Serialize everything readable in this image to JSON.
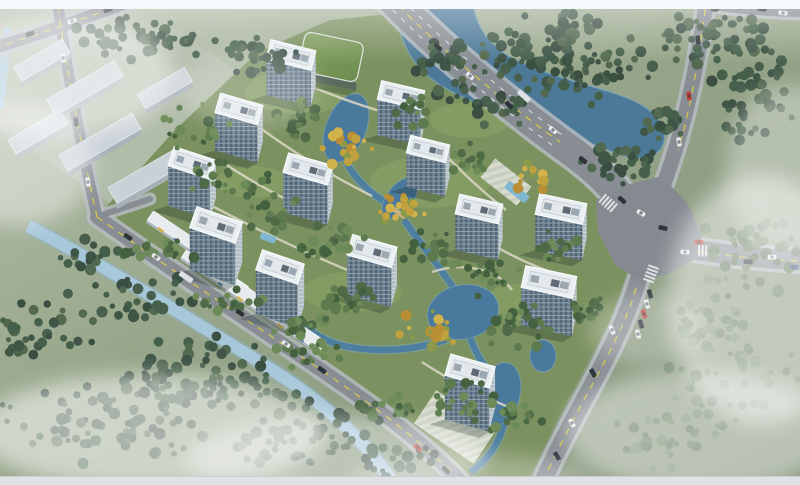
{
  "scene": {
    "type": "architectural-aerial-rendering",
    "title": "Residential community aerial rendering",
    "description": "Bird's-eye architectural rendering of a high-rise residential community: 13 white towers with blue-grey glazed facades, a green-roof clubhouse, landscaped gardens with ponds and autumn trees, a winding river, boundary roads with traffic and a large intersection, grey warehouses to the northwest and misty forest belts around the site.",
    "tower_count": 13,
    "view": "oblique aerial perspective"
  },
  "canvas": {
    "width": 800,
    "height": 485
  },
  "frame": {
    "top_band_h": 9,
    "bottom_band_h": 8,
    "top_band_color": "#f5f9fb",
    "bottom_band_color": "#dfe3e5"
  },
  "palette": {
    "ground_light": "#b7c1ae",
    "ground_mid": "#97a68a",
    "ground_dark": "#7e8f74",
    "site_green": "#7b9160",
    "lawn": "#8aa468",
    "field": "#b3bdab",
    "river": "#4d7998",
    "river_edge": "#7fa9c2",
    "canal": "#a7c7da",
    "canal_edge": "#8fb3c6",
    "lagoon": "#49799c",
    "stream": "#4f7fa0",
    "pool": "#7fb6d0",
    "asphalt": "#878d93",
    "asphalt_x": "#848a90",
    "sidewalk": "#b5bbc1",
    "line_yellow": "#d4c54b",
    "line_white": "#e8ebee",
    "roof": "#eaeff2",
    "roof_edge": "#f7fafb",
    "parapet": "#c3ccd2",
    "roof_inner": "#e2e8eb",
    "facade_end": "#b7c1c9",
    "unit_grey": "#9aa7b0",
    "unit_dark": "#5f6c77",
    "warehouse_roof": "#c9d1d7",
    "warehouse_side": "#a7b1b8",
    "warehouse_ridge": "#dde3e7",
    "green_roof_a": "#6f8c51",
    "green_roof_b": "#82a05f",
    "green_roof_side": "#5a6a5e",
    "strip_roof": "#e7ebee",
    "strip_side": "#aeb6bd",
    "strip_yellow": "#d9b34a",
    "strip_blue": "#5b84a8",
    "walkway": "#dcd7c4",
    "plaza_a": "#ccd1c4",
    "plaza_b": "#dde0d5",
    "bridge": "#c8b083",
    "shadow": "rgba(30,45,40,0.30)",
    "cars": {
      "d": "#2d3339",
      "w": "#e9ebed",
      "r": "#c2403a",
      "n": "#3c5a86",
      "t": "#dde1e4"
    },
    "trees": {
      "f": [
        "#3f5647",
        "#475f4c",
        "#52694f",
        "#3a4f42",
        "#44604a"
      ],
      "s": [
        "#4e6a46",
        "#5d7b4f",
        "#6d8b58",
        "#43603f"
      ],
      "a": [
        "#c2a23f",
        "#d1b24b",
        "#b98f35",
        "#8a9a4a"
      ],
      "l": [
        "#5c7258",
        "#67805f",
        "#72896a",
        "#617a5c"
      ]
    }
  },
  "ground": {
    "site_polygon": "96,218 175,130 258,52 330,20 390,14 445,55 520,115 575,158 618,205 636,248 610,320 565,405 528,480 470,482 420,430 340,382 250,318 160,262",
    "field_polygon": "0,38 140,4 250,80 210,150 120,210 0,130",
    "lawns": [
      [
        300,
        92,
        55,
        22
      ],
      [
        430,
        182,
        60,
        26
      ],
      [
        352,
        292,
        50,
        20
      ],
      [
        520,
        302,
        40,
        18
      ],
      [
        252,
        182,
        36,
        16
      ],
      [
        470,
        120,
        40,
        18
      ]
    ]
  },
  "water": {
    "river_path": "M394,8 L474,8 C478,30 492,48 516,60 C548,76 588,84 622,96 C650,106 668,122 664,142 C660,158 640,162 618,154 C586,142 552,128 516,116 C478,104 440,92 418,66 C404,50 398,28 394,8 Z",
    "canal_path": "M28,226 C105,266 188,318 266,366 C322,400 368,442 396,488",
    "creek_path": "M8,28 C5,55 3,80 0,108",
    "lagoon_blobs": [
      [
        346,
        128,
        20,
        36,
        22
      ],
      [
        400,
        198,
        13,
        24,
        38
      ],
      [
        463,
        312,
        36,
        27,
        -12
      ],
      [
        500,
        394,
        20,
        32,
        14
      ],
      [
        543,
        356,
        13,
        16,
        0
      ]
    ],
    "streams": [
      "M346,162 C358,184 376,198 396,208",
      "M404,220 C422,246 444,272 456,292",
      "M470,338 C478,358 488,372 496,380",
      "M504,424 C498,446 486,462 470,472",
      "M460,334 C424,350 382,354 344,346 C328,342 316,336 306,326"
    ],
    "bridge": [
      399,
      213,
      15,
      5,
      35
    ]
  },
  "roads": [
    {
      "name": "top-left-road",
      "d": "M-6,48 C40,34 92,16 150,-6",
      "w": 12,
      "mark": "M-6,48 C40,34 92,16 150,-6"
    },
    {
      "name": "west-road",
      "d": "M58,6 C68,78 82,150 97,217",
      "w": 11,
      "mark": "M58,6 C68,78 82,150 97,217"
    },
    {
      "name": "sw-boundary-road",
      "d": "M97,217 C160,262 235,312 302,357 C355,393 420,437 465,486",
      "w": 14,
      "mark": "M97,217 C160,262 235,312 302,357 C355,393 420,437 465,486"
    },
    {
      "name": "west-gate-spur",
      "d": "M99,216 L150,199",
      "w": 6
    },
    {
      "name": "top-arterial",
      "d": "M389,-4 C437,46 505,103 567,148 C595,168 614,186 628,208",
      "w": 30,
      "mark": "M389,-4 C437,46 505,103 560,142",
      "lane_offset": [
        4.6,
        -5.3
      ]
    },
    {
      "name": "northeast-road",
      "d": "M707,-4 C699,55 688,115 668,172 C664,184 660,196 657,206",
      "w": 15,
      "mark": "M707,-4 C700,50 692,105 678,150"
    },
    {
      "name": "east-road",
      "d": "M652,242 C700,252 750,258 806,261",
      "w": 20,
      "mark": "M700,252 C735,257 770,260 806,261"
    },
    {
      "name": "south-road",
      "d": "M642,266 C632,308 610,352 585,398 C568,430 552,460 540,488",
      "w": 17,
      "mark": "M636,288 C628,318 608,356 585,398 C568,430 552,460 540,488"
    },
    {
      "name": "top-right-frontage",
      "d": "M720,6 C750,10 780,12 806,12",
      "w": 10
    }
  ],
  "intersection_polygon": "596,200 630,184 662,176 688,204 702,236 694,260 668,274 642,282 616,266 598,232",
  "crosswalks": [
    [
      608,
      203,
      41
    ],
    [
      651,
      274,
      -70
    ],
    [
      706,
      251,
      2
    ]
  ],
  "warehouses": [
    [
      42,
      60,
      56,
      16
    ],
    [
      85,
      88,
      78,
      18
    ],
    [
      165,
      88,
      54,
      16
    ],
    [
      38,
      132,
      60,
      16
    ],
    [
      100,
      142,
      84,
      18
    ],
    [
      148,
      175,
      82,
      18
    ]
  ],
  "green_roof_building": {
    "x": 331,
    "y": 57,
    "w": 60,
    "d": 40,
    "rot": 12
  },
  "towers": [
    [
      291,
      55,
      46,
      20,
      36,
      14
    ],
    [
      401,
      95,
      44,
      19,
      36,
      13
    ],
    [
      239,
      109,
      44,
      20,
      38,
      16
    ],
    [
      428,
      149,
      40,
      18,
      34,
      14
    ],
    [
      192,
      163,
      44,
      20,
      40,
      18
    ],
    [
      308,
      169,
      46,
      20,
      40,
      16
    ],
    [
      479,
      209,
      44,
      20,
      36,
      13
    ],
    [
      561,
      209,
      48,
      21,
      36,
      12
    ],
    [
      216,
      225,
      48,
      22,
      42,
      19
    ],
    [
      372,
      251,
      46,
      21,
      40,
      16
    ],
    [
      280,
      267,
      44,
      21,
      44,
      19
    ],
    [
      549,
      282,
      52,
      22,
      38,
      12
    ],
    [
      470,
      371,
      46,
      22,
      44,
      16
    ]
  ],
  "commercial_strips": [
    [
      215,
      272,
      72,
      13,
      34
    ],
    [
      256,
      301,
      72,
      13,
      34
    ],
    [
      295,
      328,
      66,
      12,
      34
    ],
    [
      172,
      230,
      52,
      11,
      34
    ]
  ],
  "plazas": [
    [
      455,
      427,
      72,
      40,
      34
    ],
    [
      506,
      182,
      46,
      24,
      38
    ]
  ],
  "pools": [
    [
      517,
      192,
      26,
      9,
      38
    ],
    [
      268,
      238,
      16,
      7,
      20
    ]
  ],
  "walkways": [
    "M212,206 C262,232 312,256 362,276",
    "M252,122 C292,152 332,176 372,196",
    "M302,82 C332,96 362,106 396,116",
    "M432,142 C456,166 480,190 506,210",
    "M472,232 C502,252 532,266 562,276",
    "M422,362 C452,382 482,396 506,406",
    "M432,272 C462,262 496,268 512,290",
    "M222,162 C252,182 282,198 312,212"
  ],
  "tree_clusters": [
    [
      150,
      38,
      95,
      26,
      45,
      "f"
    ],
    [
      262,
      58,
      50,
      24,
      26,
      "f"
    ],
    [
      430,
      58,
      40,
      22,
      18,
      "f"
    ],
    [
      500,
      108,
      40,
      20,
      16,
      "f"
    ],
    [
      558,
      58,
      115,
      52,
      120,
      "f"
    ],
    [
      712,
      38,
      75,
      38,
      55,
      "f"
    ],
    [
      755,
      95,
      55,
      60,
      48,
      "f"
    ],
    [
      620,
      162,
      52,
      28,
      38,
      "f"
    ],
    [
      662,
      122,
      30,
      24,
      20,
      "f"
    ],
    [
      748,
      258,
      68,
      48,
      42,
      "l"
    ],
    [
      728,
      378,
      78,
      66,
      52,
      "l"
    ],
    [
      662,
      438,
      58,
      38,
      30,
      "l"
    ],
    [
      710,
      318,
      48,
      38,
      26,
      "l"
    ],
    [
      118,
      418,
      128,
      58,
      85,
      "f"
    ],
    [
      298,
      432,
      88,
      48,
      52,
      "f"
    ],
    [
      40,
      328,
      58,
      48,
      34,
      "f"
    ],
    [
      198,
      368,
      78,
      38,
      42,
      "f"
    ],
    [
      388,
      458,
      58,
      26,
      22,
      "f"
    ],
    [
      138,
      298,
      65,
      28,
      28,
      "f"
    ],
    [
      88,
      258,
      48,
      20,
      20,
      "f"
    ],
    [
      252,
      390,
      70,
      20,
      24,
      "f"
    ],
    [
      198,
      128,
      38,
      28,
      18,
      "s"
    ],
    [
      228,
      178,
      55,
      22,
      22,
      "s"
    ],
    [
      298,
      118,
      38,
      26,
      24,
      "s"
    ],
    [
      348,
      148,
      32,
      22,
      18,
      "a"
    ],
    [
      268,
      212,
      38,
      22,
      20,
      "s"
    ],
    [
      330,
      238,
      42,
      26,
      24,
      "s"
    ],
    [
      394,
      208,
      32,
      22,
      18,
      "a"
    ],
    [
      432,
      248,
      38,
      26,
      22,
      "s"
    ],
    [
      488,
      278,
      38,
      25,
      20,
      "s"
    ],
    [
      520,
      328,
      42,
      27,
      24,
      "s"
    ],
    [
      560,
      248,
      32,
      20,
      16,
      "s"
    ],
    [
      430,
      328,
      38,
      22,
      20,
      "a"
    ],
    [
      462,
      398,
      42,
      27,
      24,
      "s"
    ],
    [
      508,
      418,
      38,
      22,
      18,
      "s"
    ],
    [
      348,
      298,
      42,
      22,
      22,
      "s"
    ],
    [
      300,
      330,
      38,
      20,
      18,
      "s"
    ],
    [
      412,
      110,
      28,
      18,
      14,
      "s"
    ],
    [
      470,
      158,
      32,
      20,
      16,
      "s"
    ],
    [
      532,
      178,
      28,
      18,
      13,
      "a"
    ],
    [
      152,
      252,
      48,
      16,
      18,
      "s"
    ],
    [
      230,
      300,
      55,
      16,
      20,
      "s"
    ],
    [
      310,
      354,
      55,
      16,
      20,
      "s"
    ],
    [
      388,
      408,
      50,
      16,
      18,
      "s"
    ],
    [
      452,
      92,
      26,
      16,
      12,
      "f"
    ],
    [
      588,
      310,
      30,
      18,
      14,
      "s"
    ]
  ],
  "cars": [
    [
      438,
      47,
      45,
      "d"
    ],
    [
      470,
      76,
      44,
      "w"
    ],
    [
      509,
      105,
      43,
      "d"
    ],
    [
      524,
      96,
      43,
      "t"
    ],
    [
      553,
      130,
      41,
      "w"
    ],
    [
      583,
      160,
      40,
      "d"
    ],
    [
      762,
      9,
      6,
      "d"
    ],
    [
      783,
      13,
      6,
      "w"
    ],
    [
      698,
      40,
      83,
      "d"
    ],
    [
      689,
      96,
      82,
      "r"
    ],
    [
      679,
      142,
      80,
      "w"
    ],
    [
      622,
      200,
      41,
      "d"
    ],
    [
      641,
      213,
      30,
      "w"
    ],
    [
      663,
      228,
      12,
      "d"
    ],
    [
      699,
      242,
      4,
      "r"
    ],
    [
      685,
      252,
      4,
      "w"
    ],
    [
      748,
      262,
      4,
      "d"
    ],
    [
      772,
      257,
      3,
      "w"
    ],
    [
      794,
      267,
      3,
      "n"
    ],
    [
      650,
      294,
      74,
      "d"
    ],
    [
      647,
      304,
      74,
      "w"
    ],
    [
      644,
      314,
      74,
      "r"
    ],
    [
      641,
      324,
      75,
      "d"
    ],
    [
      638,
      334,
      75,
      "w"
    ],
    [
      612,
      330,
      68,
      "w"
    ],
    [
      593,
      373,
      63,
      "d"
    ],
    [
      572,
      423,
      60,
      "w"
    ],
    [
      557,
      456,
      58,
      "d"
    ],
    [
      128,
      237,
      34,
      "d"
    ],
    [
      156,
      257,
      34,
      "w"
    ],
    [
      186,
      277,
      34,
      "t"
    ],
    [
      240,
      313,
      34,
      "d"
    ],
    [
      286,
      344,
      33,
      "w"
    ],
    [
      322,
      370,
      35,
      "d"
    ],
    [
      418,
      448,
      42,
      "r"
    ],
    [
      446,
      470,
      44,
      "d"
    ],
    [
      63,
      58,
      82,
      "w"
    ],
    [
      76,
      122,
      83,
      "d"
    ],
    [
      88,
      182,
      83,
      "w"
    ],
    [
      30,
      34,
      -17,
      "d"
    ],
    [
      72,
      21,
      -17,
      "w"
    ],
    [
      108,
      10,
      -17,
      "d"
    ]
  ],
  "mists": [
    [
      60,
      75,
      115,
      62,
      0.5
    ],
    [
      18,
      165,
      75,
      60,
      0.42
    ],
    [
      150,
      432,
      175,
      58,
      0.55
    ],
    [
      335,
      458,
      150,
      42,
      0.42
    ],
    [
      762,
      300,
      95,
      125,
      0.5
    ],
    [
      700,
      432,
      135,
      62,
      0.45
    ],
    [
      788,
      170,
      62,
      85,
      0.35
    ],
    [
      470,
      480,
      120,
      26,
      0.3
    ],
    [
      248,
      88,
      70,
      40,
      0.25
    ],
    [
      648,
      330,
      60,
      36,
      0.28
    ]
  ]
}
